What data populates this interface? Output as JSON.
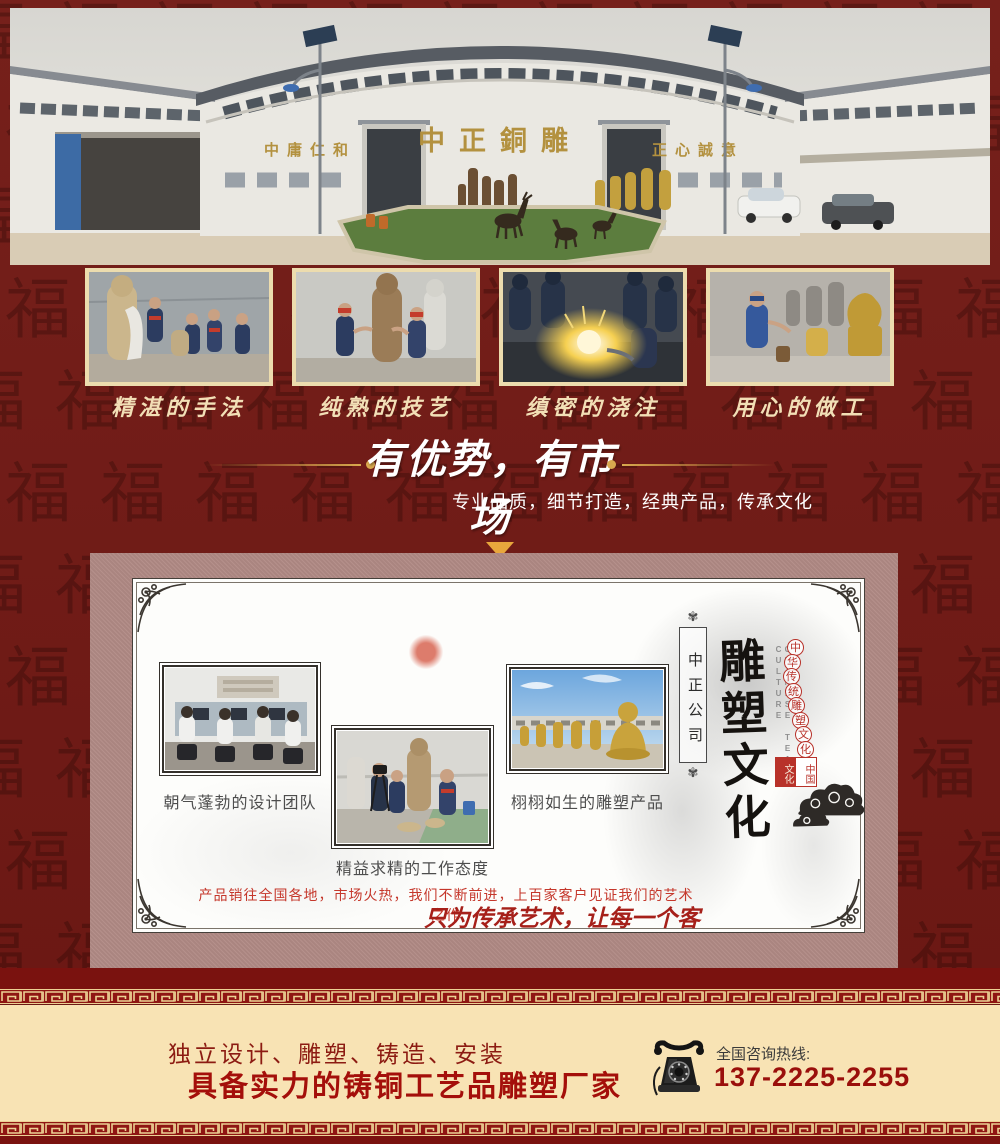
{
  "colors": {
    "page_bg": "#701a16",
    "panel_bg": "#b18a85",
    "cream": "#f8e3b4",
    "gold": "#d9a94e",
    "dark_bar": "#7a120f",
    "meander_red": "#8f1613",
    "headline_red": "#a40f0a",
    "sign_gold": "#b3913f"
  },
  "background": {
    "pattern_char": "福"
  },
  "hero": {
    "sign_left": "中庸仁和",
    "sign_center": "中正銅雕",
    "sign_right": "正心誠意"
  },
  "process": {
    "items": [
      {
        "caption": "精湛的手法"
      },
      {
        "caption": "纯熟的技艺"
      },
      {
        "caption": "缜密的浇注"
      },
      {
        "caption": "用心的做工"
      }
    ]
  },
  "advantage": {
    "title": "有优势，有市场",
    "subtitle": "专业品质，细节打造，经典产品，传承文化"
  },
  "showcase": {
    "captions": [
      "朝气蓬勃的设计团队",
      "精益求精的工作态度",
      "栩栩如生的雕塑产品"
    ],
    "seal_banner": "中正公司",
    "vertical_title": "雕塑文化",
    "vertical_en": "CHINESE TEA CULTURE",
    "medallion_text": "中华传统雕塑文化",
    "stamp_left": "文化",
    "stamp_right": "中国",
    "market_line": "产品销往全国各地，市场火热，我们不断前进，上百家客户见证我们的艺术之作",
    "slogan": "只为传承艺术，让每一个客户满意"
  },
  "footer": {
    "services": "独立设计、雕塑、铸造、安装",
    "headline": "具备实力的铸铜工艺品雕塑厂家",
    "hotline_label": "全国咨询热线:",
    "phone": "137-2225-2255"
  }
}
